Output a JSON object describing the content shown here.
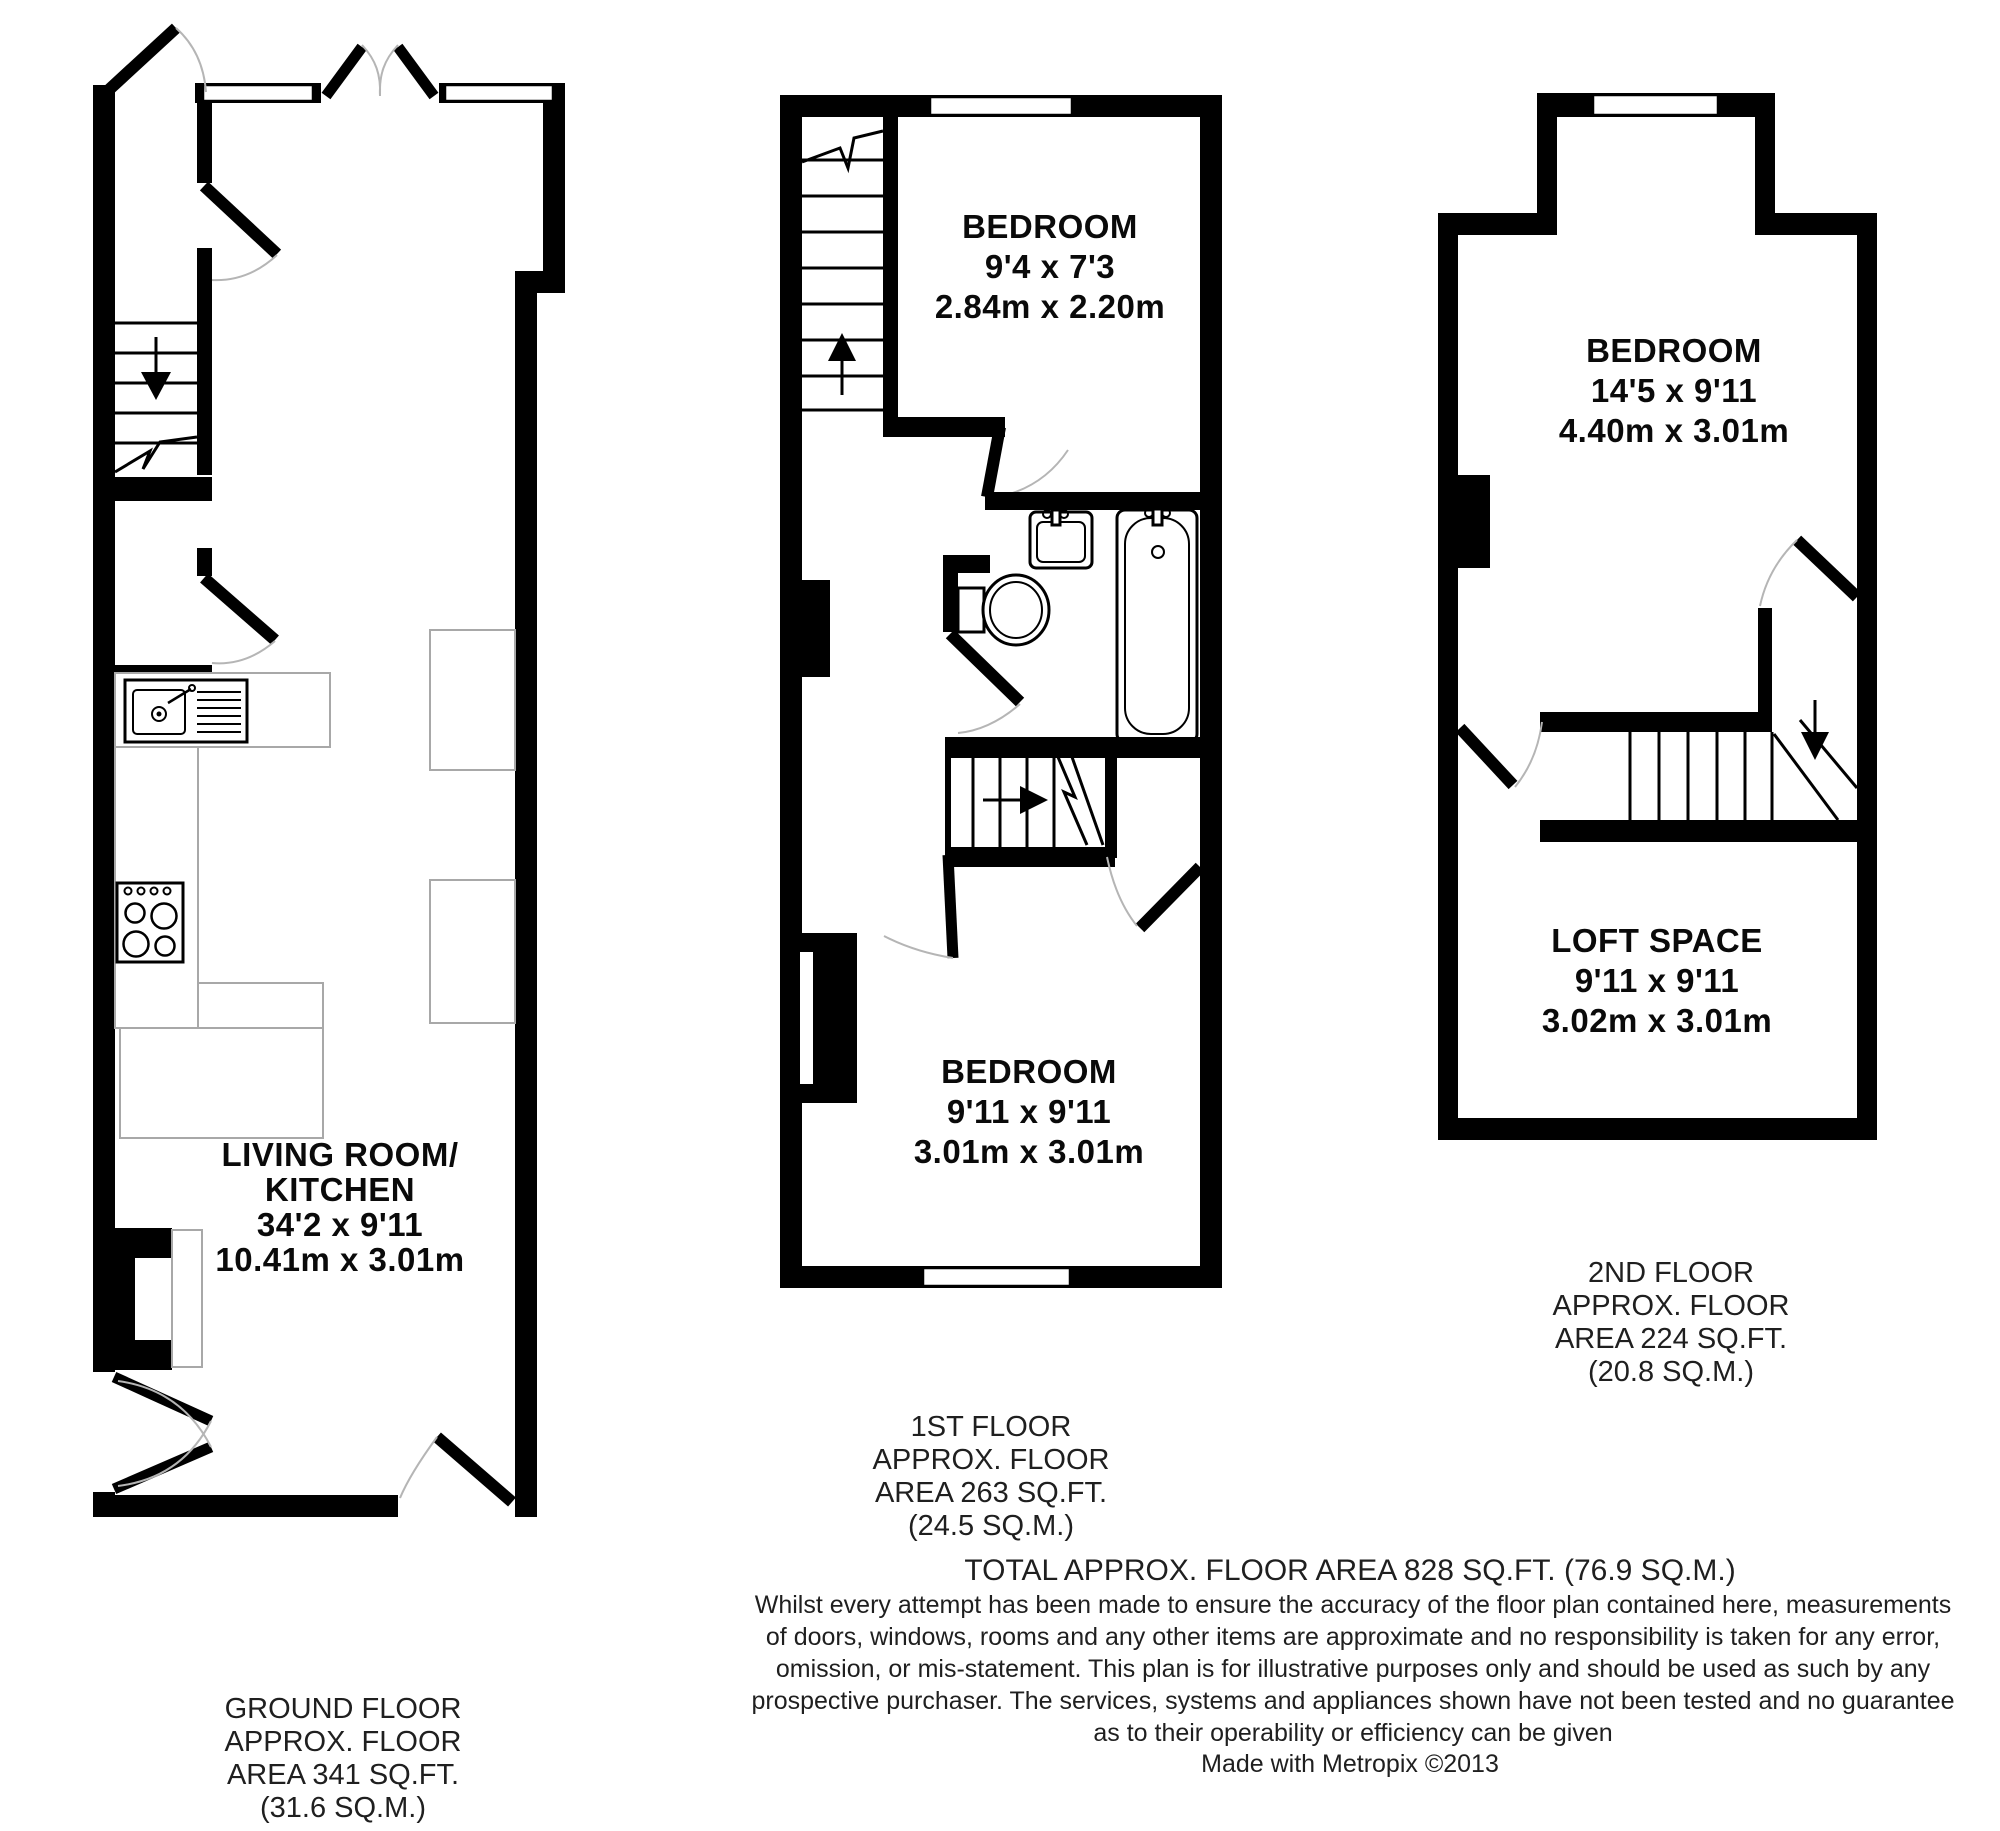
{
  "document": {
    "type": "floorplan",
    "background": "#ffffff",
    "colors": {
      "wall": "#000000",
      "fixture_outline": "#000000",
      "furniture_outline": "#a8a8a8",
      "door_arc": "#b5b5b5",
      "text": "#1f1f1f"
    },
    "fixtures": [
      "staircase",
      "stair-direction-arrow",
      "window",
      "door-leaf",
      "door-swing-arc",
      "kitchen-sink",
      "stove",
      "kitchen-counter",
      "toilet",
      "wash-basin",
      "bathtub",
      "chimney-breast",
      "radiator",
      "furniture"
    ]
  },
  "plans": {
    "ground": {
      "room": {
        "line1": "LIVING ROOM/",
        "line2": "KITCHEN",
        "imperial": "34'2 x 9'11",
        "metric": "10.41m x 3.01m"
      },
      "floor_label": [
        "GROUND FLOOR",
        "APPROX. FLOOR",
        "AREA 341 SQ.FT.",
        "(31.6 SQ.M.)"
      ]
    },
    "first": {
      "bedroom_top": {
        "name": "BEDROOM",
        "imperial": "9'4 x 7'3",
        "metric": "2.84m x 2.20m"
      },
      "bedroom_bottom": {
        "name": "BEDROOM",
        "imperial": "9'11 x 9'11",
        "metric": "3.01m x 3.01m"
      },
      "floor_label": [
        "1ST FLOOR",
        "APPROX. FLOOR",
        "AREA 263 SQ.FT.",
        "(24.5 SQ.M.)"
      ]
    },
    "second": {
      "bedroom": {
        "name": "BEDROOM",
        "imperial": "14'5 x 9'11",
        "metric": "4.40m x 3.01m"
      },
      "loft": {
        "name": "LOFT SPACE",
        "imperial": "9'11 x 9'11",
        "metric": "3.02m x 3.01m"
      },
      "floor_label": [
        "2ND FLOOR",
        "APPROX. FLOOR",
        "AREA 224 SQ.FT.",
        "(20.8 SQ.M.)"
      ]
    }
  },
  "footer": {
    "total": "TOTAL APPROX. FLOOR AREA 828 SQ.FT. (76.9 SQ.M.)",
    "disclaimer": [
      "Whilst every attempt has been made to ensure the accuracy of the floor plan contained here, measurements",
      "of doors, windows, rooms and any other items are approximate and no responsibility is taken for any error,",
      "omission, or mis-statement. This plan is for illustrative purposes only and should be used as such by any",
      "prospective purchaser. The services, systems and appliances shown have not been tested and no guarantee",
      "as to their operability or efficiency can be given"
    ],
    "credit": "Made with Metropix ©2013"
  }
}
